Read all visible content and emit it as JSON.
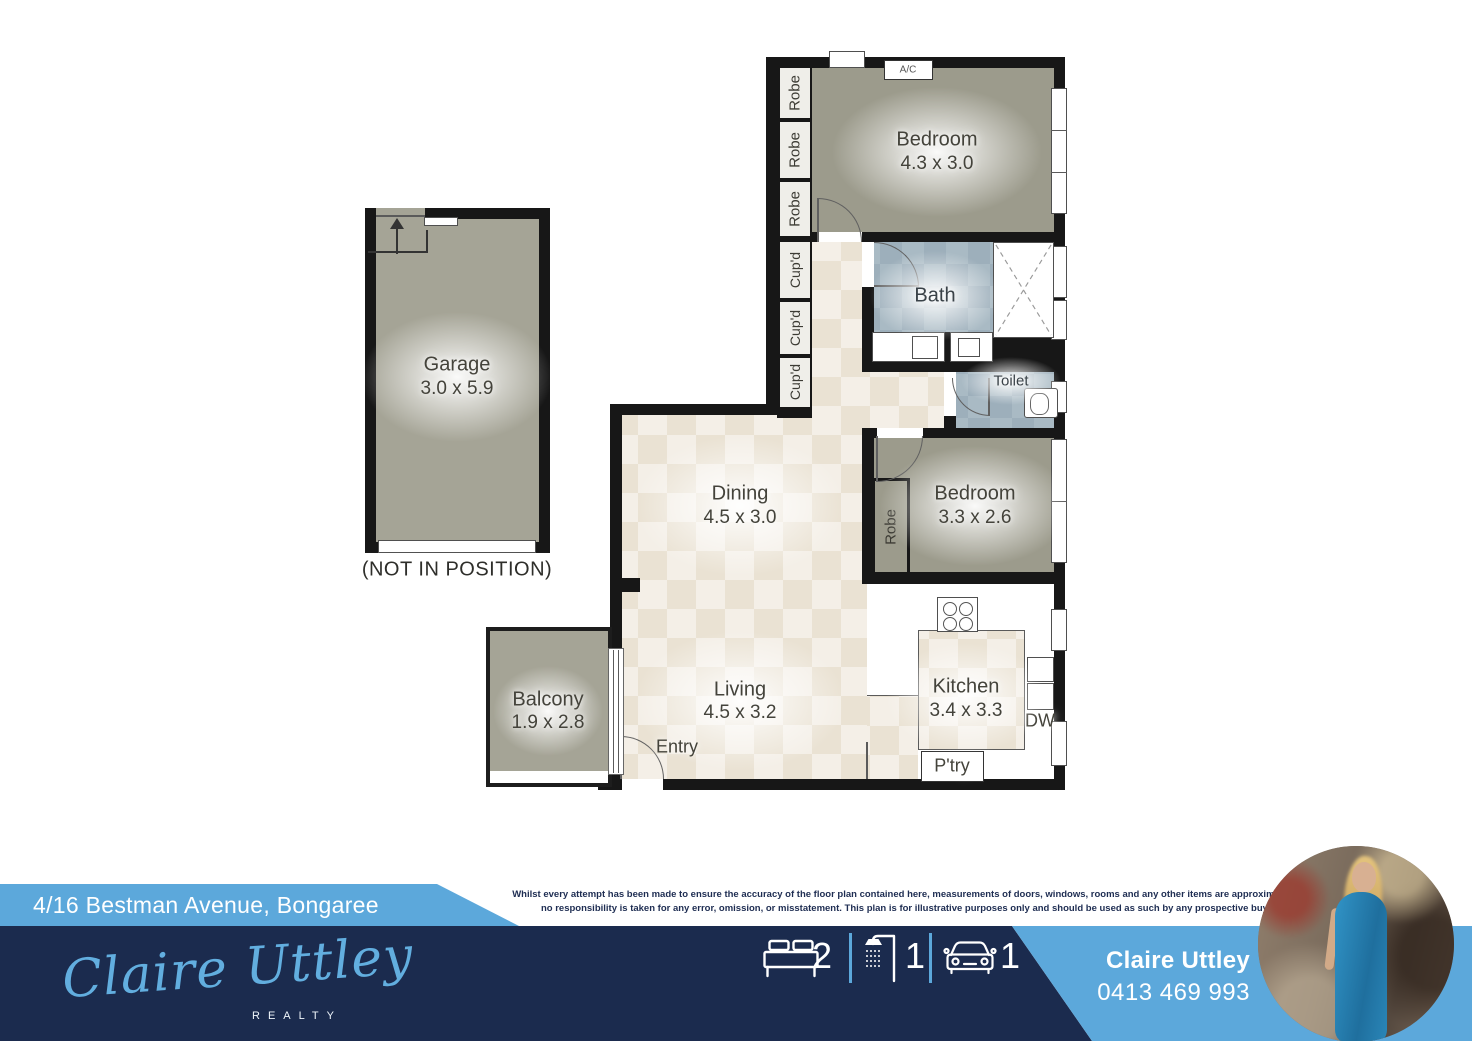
{
  "plan": {
    "garage": {
      "name": "Garage",
      "dims": "3.0 x 5.9",
      "note": "(NOT IN POSITION)"
    },
    "bedroom1": {
      "name": "Bedroom",
      "dims": "4.3 x 3.0"
    },
    "bedroom2": {
      "name": "Bedroom",
      "dims": "3.3 x 2.6"
    },
    "bath": {
      "name": "Bath"
    },
    "toilet": {
      "name": "Toilet"
    },
    "dining": {
      "name": "Dining",
      "dims": "4.5 x 3.0"
    },
    "living": {
      "name": "Living",
      "dims": "4.5 x 3.2"
    },
    "kitchen": {
      "name": "Kitchen",
      "dims": "3.4 x 3.3"
    },
    "balcony": {
      "name": "Balcony",
      "dims": "1.9 x 2.8"
    },
    "entry_label": "Entry",
    "pantry_label": "P'try",
    "dw_label": "DW",
    "ac_label": "A/C",
    "robe_label": "Robe",
    "cupd_label": "Cup'd"
  },
  "banner": {
    "address": "4/16 Bestman Avenue, Bongaree",
    "disclaimer_line1": "Whilst every attempt has been made to ensure the accuracy of the floor plan contained here, measurements of doors, windows, rooms and any other items are approximate and",
    "disclaimer_line2": "no responsibility is taken for any error, omission, or misstatement. This plan is for illustrative purposes only and should be used as such by any prospective buyer.",
    "stats": {
      "beds": "2",
      "baths": "1",
      "cars": "1"
    },
    "agent": {
      "name": "Claire Uttley",
      "phone": "0413 469 993"
    },
    "logo": {
      "script": "Claire Uttley",
      "sub": "REALTY"
    }
  },
  "colors": {
    "light_blue": "#5CA8DB",
    "navy": "#1B2B4E",
    "olive": "#9C9B8C",
    "wall": "#171717"
  }
}
